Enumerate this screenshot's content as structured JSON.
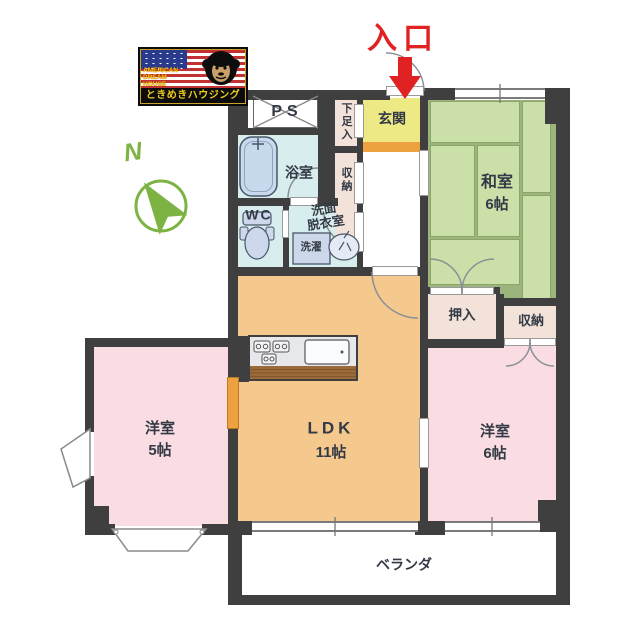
{
  "branding": {
    "flag_text_lines": [
      "AMERICAN",
      "DREAM",
      "HOUSE"
    ],
    "agency_name": "ときめきハウジング"
  },
  "annotations": {
    "entrance_label": "入口",
    "compass_label": "N",
    "veranda_label": "ベランダ"
  },
  "rooms": {
    "ps": {
      "label": "PS"
    },
    "bathroom": {
      "label": "浴室"
    },
    "shoe_cabinet": {
      "label": "下足入"
    },
    "hall_storage": {
      "label": "収納"
    },
    "entry_hall": {
      "label": "玄関"
    },
    "toilet": {
      "label": "WC"
    },
    "washroom": {
      "line1": "洗面",
      "line2": "脱衣室"
    },
    "laundry": {
      "label": "洗濯"
    },
    "japanese_room": {
      "label": "和室",
      "size": "6帖"
    },
    "oshiire_closet": {
      "label": "押入"
    },
    "bedroom_storage": {
      "label": "収納"
    },
    "ldk": {
      "label": "LDK",
      "size": "11帖"
    },
    "western_room_5": {
      "label": "洋室",
      "size": "5帖"
    },
    "western_room_6": {
      "label": "洋室",
      "size": "6帖"
    }
  },
  "colors": {
    "wall": "#3f3f40",
    "entrance_red": "#e12222",
    "compass_green": "#7cb342",
    "tatami_green": "#cbe0a8",
    "ldk_orange": "#f5c98e",
    "western_room_pink": "#fadde2",
    "wet_area_cyan": "#d8eeee",
    "closet_beige": "#f2e2d9",
    "genkan_yellow": "#ede984",
    "step_orange": "#eda23f"
  }
}
